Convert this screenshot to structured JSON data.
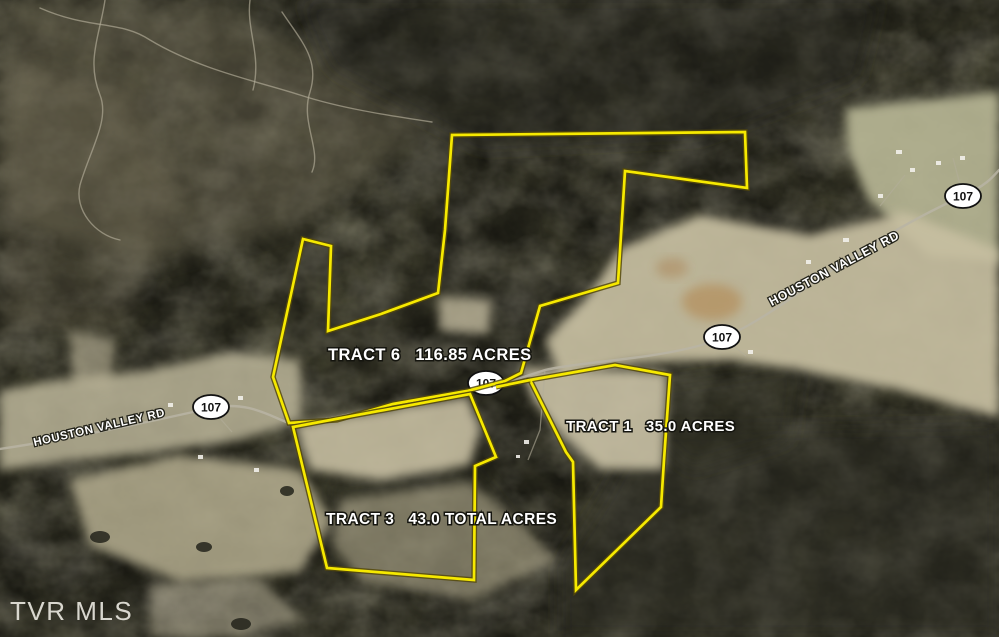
{
  "map": {
    "watermark": "TVR MLS",
    "colors": {
      "boundary_yellow": "#f6e900",
      "boundary_edge": "#55490a",
      "label_fill": "#ffffff",
      "label_outline": "#15150f",
      "shield_fill": "#ffffff",
      "shield_border": "#111111",
      "forest_dark": "#3e3d2f",
      "field_tan": "#c7bfa2"
    },
    "roads": {
      "name": "HOUSTON VALLEY RD",
      "route_shield": "107"
    },
    "tracts": [
      {
        "name": "TRACT 6",
        "acreage": "116.85 ACRES",
        "label": "TRACT 6   116.85 ACRES",
        "points": "452,135 745,132 747,188 625,171 618,283 540,306 521,373 505,381 467,391 393,404 337,420 289,423 273,377 303,239 331,246 328,331 381,314 438,293 445,230"
      },
      {
        "name": "TRACT 1",
        "acreage": "35.0 ACRES",
        "label": "TRACT 1   35.0 ACRES",
        "points": "530,380 615,365 670,375 664,460 661,507 576,590 573,462 566,452"
      },
      {
        "name": "TRACT 3",
        "acreage": "43.0 TOTAL ACRES",
        "label": "TRACT 3   43.0 TOTAL ACRES",
        "points": "293,427 470,394 496,457 475,466 474,580 327,568"
      }
    ],
    "connector_points": "496,387 530,380"
  }
}
